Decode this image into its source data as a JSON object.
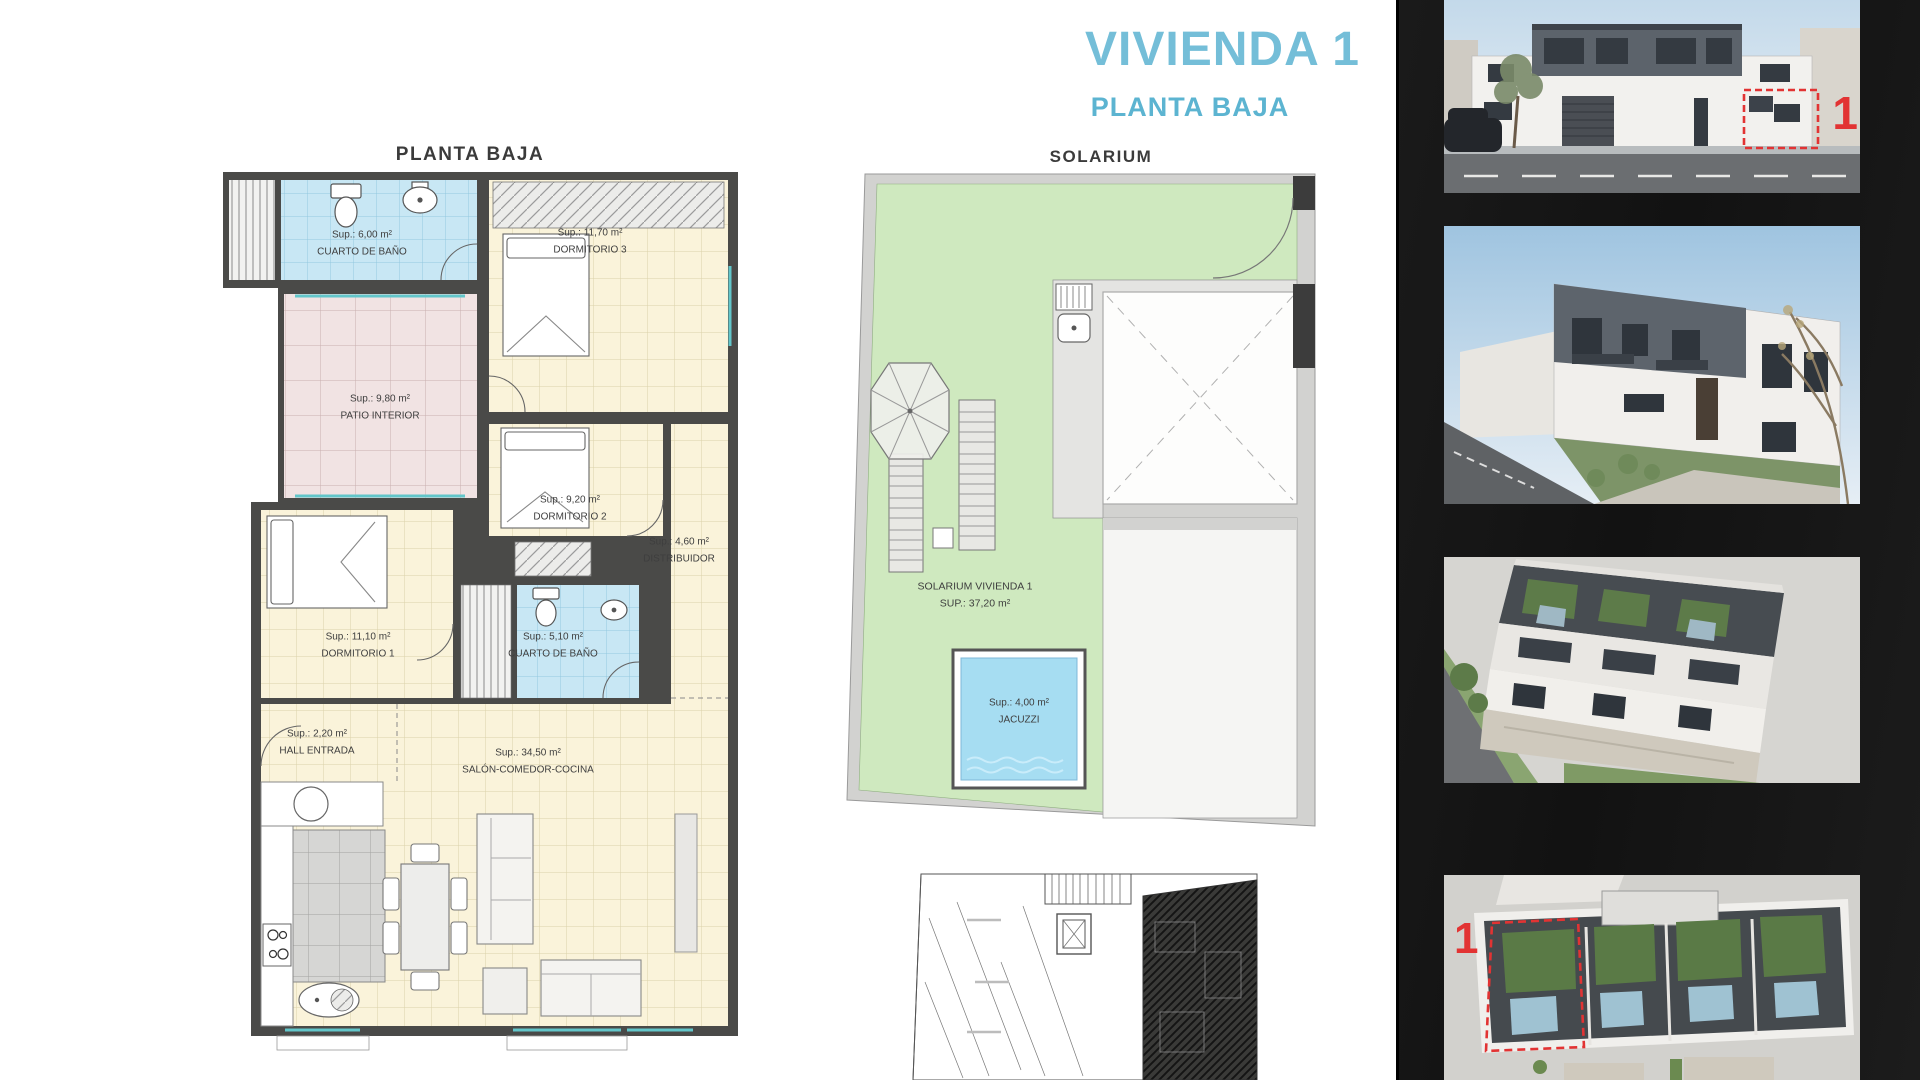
{
  "header": {
    "title": "VIVIENDA 1",
    "subtitle": "PLANTA BAJA"
  },
  "floorplan": {
    "title": "PLANTA BAJA",
    "rooms": [
      {
        "area": "Sup.: 6,00 m²",
        "name": "CUARTO DE BAÑO"
      },
      {
        "area": "Sup.: 11,70 m²",
        "name": "DORMITORIO 3"
      },
      {
        "area": "Sup.: 9,80 m²",
        "name": "PATIO INTERIOR"
      },
      {
        "area": "Sup.: 9,20 m²",
        "name": "DORMITORIO 2"
      },
      {
        "area": "Sup.: 4,60 m²",
        "name": "DISTRIBUIDOR"
      },
      {
        "area": "Sup.: 11,10 m²",
        "name": "DORMITORIO 1"
      },
      {
        "area": "Sup.: 5,10 m²",
        "name": "CUARTO DE BAÑO"
      },
      {
        "area": "Sup.: 2,20 m²",
        "name": "HALL ENTRADA"
      },
      {
        "area": "Sup.: 34,50 m²",
        "name": "SALÓN-COMEDOR-COCINA"
      }
    ]
  },
  "solarium": {
    "title": "SOLARIUM",
    "label": {
      "line1": "SOLARIUM VIVIENDA 1",
      "line2": "SUP.: 37,20 m²"
    },
    "jacuzzi": {
      "area": "Sup.: 4,00 m²",
      "name": "JACUZZI"
    }
  },
  "sidebar": {
    "unit_marker": "1"
  },
  "colors": {
    "accent_blue": "#74bed8",
    "marker_red": "#e23333",
    "plan_cream": "#faf3da",
    "plan_blue": "#c8e7f4",
    "plan_pink": "#f1e3e3",
    "solarium_green": "#cfe9bf",
    "jacuzzi_blue": "#a6ddf2",
    "wall_gray": "#4a4a48",
    "sidebar_black": "#151515"
  }
}
